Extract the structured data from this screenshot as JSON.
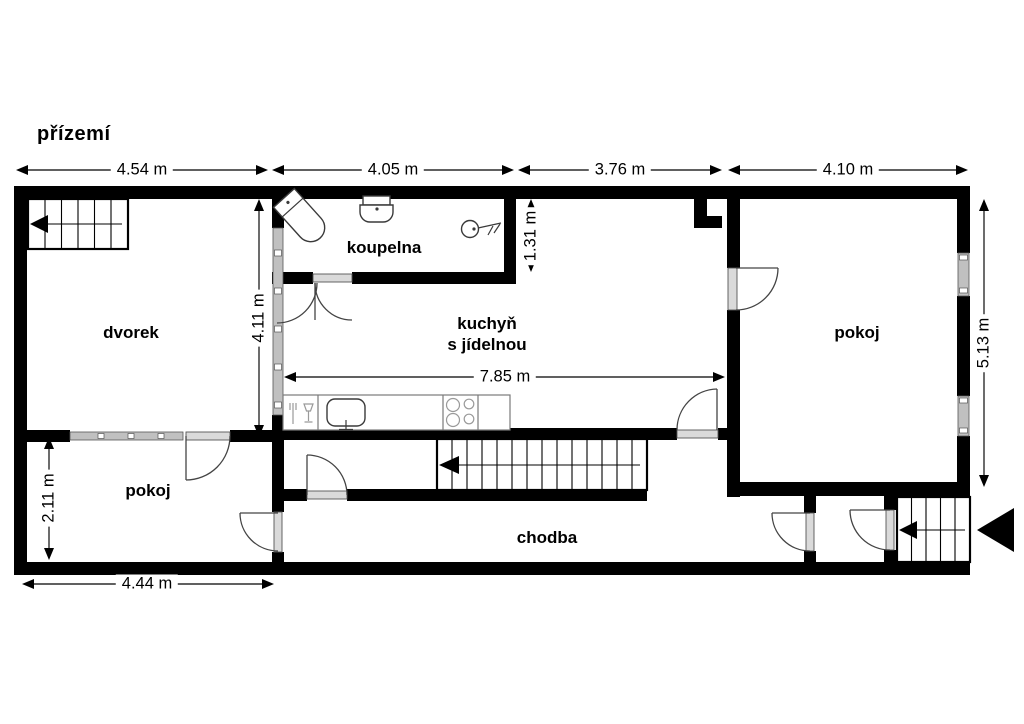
{
  "title": "přízemí",
  "rooms": {
    "dvorek": "dvorek",
    "koupelna": "koupelna",
    "kuchyn_line1": "kuchyň",
    "kuchyn_line2": "s jídelnou",
    "pokoj_right": "pokoj",
    "pokoj_left": "pokoj",
    "chodba": "chodba"
  },
  "dimensions": {
    "top": [
      "4.54 m",
      "4.05 m",
      "3.76 m",
      "4.10 m"
    ],
    "kitchen_width": "7.85 m",
    "left_room_width": "4.44 m",
    "dvorek_height": "4.11 m",
    "bathroom_height": "1.31 m",
    "pokoj_height": "5.13 m",
    "left_room_height": "2.11 m"
  },
  "colors": {
    "wall": "#000000",
    "window_fill": "#c0c0c0",
    "door_sill": "#dadada",
    "background": "#ffffff",
    "outline": "#444444"
  }
}
